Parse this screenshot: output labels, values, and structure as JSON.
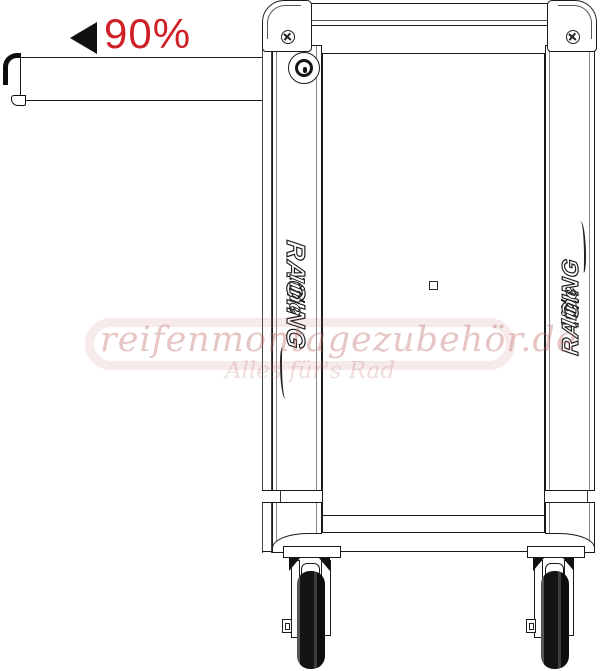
{
  "annotation": {
    "label": "90%",
    "arrow_icon": "left-triangle"
  },
  "logo": {
    "brand": "RACING",
    "sub": "line"
  },
  "watermark": {
    "line1": "reifenmontagezubehör.de",
    "line2": "Alles für's Rad"
  },
  "pegboard": {
    "rows": 18,
    "cols": 9
  },
  "colors": {
    "accent_red": "#cf2026",
    "ink": "#1a1a1a",
    "watermark_pink": "#c06a6a",
    "wheel_dark": "#141414"
  }
}
